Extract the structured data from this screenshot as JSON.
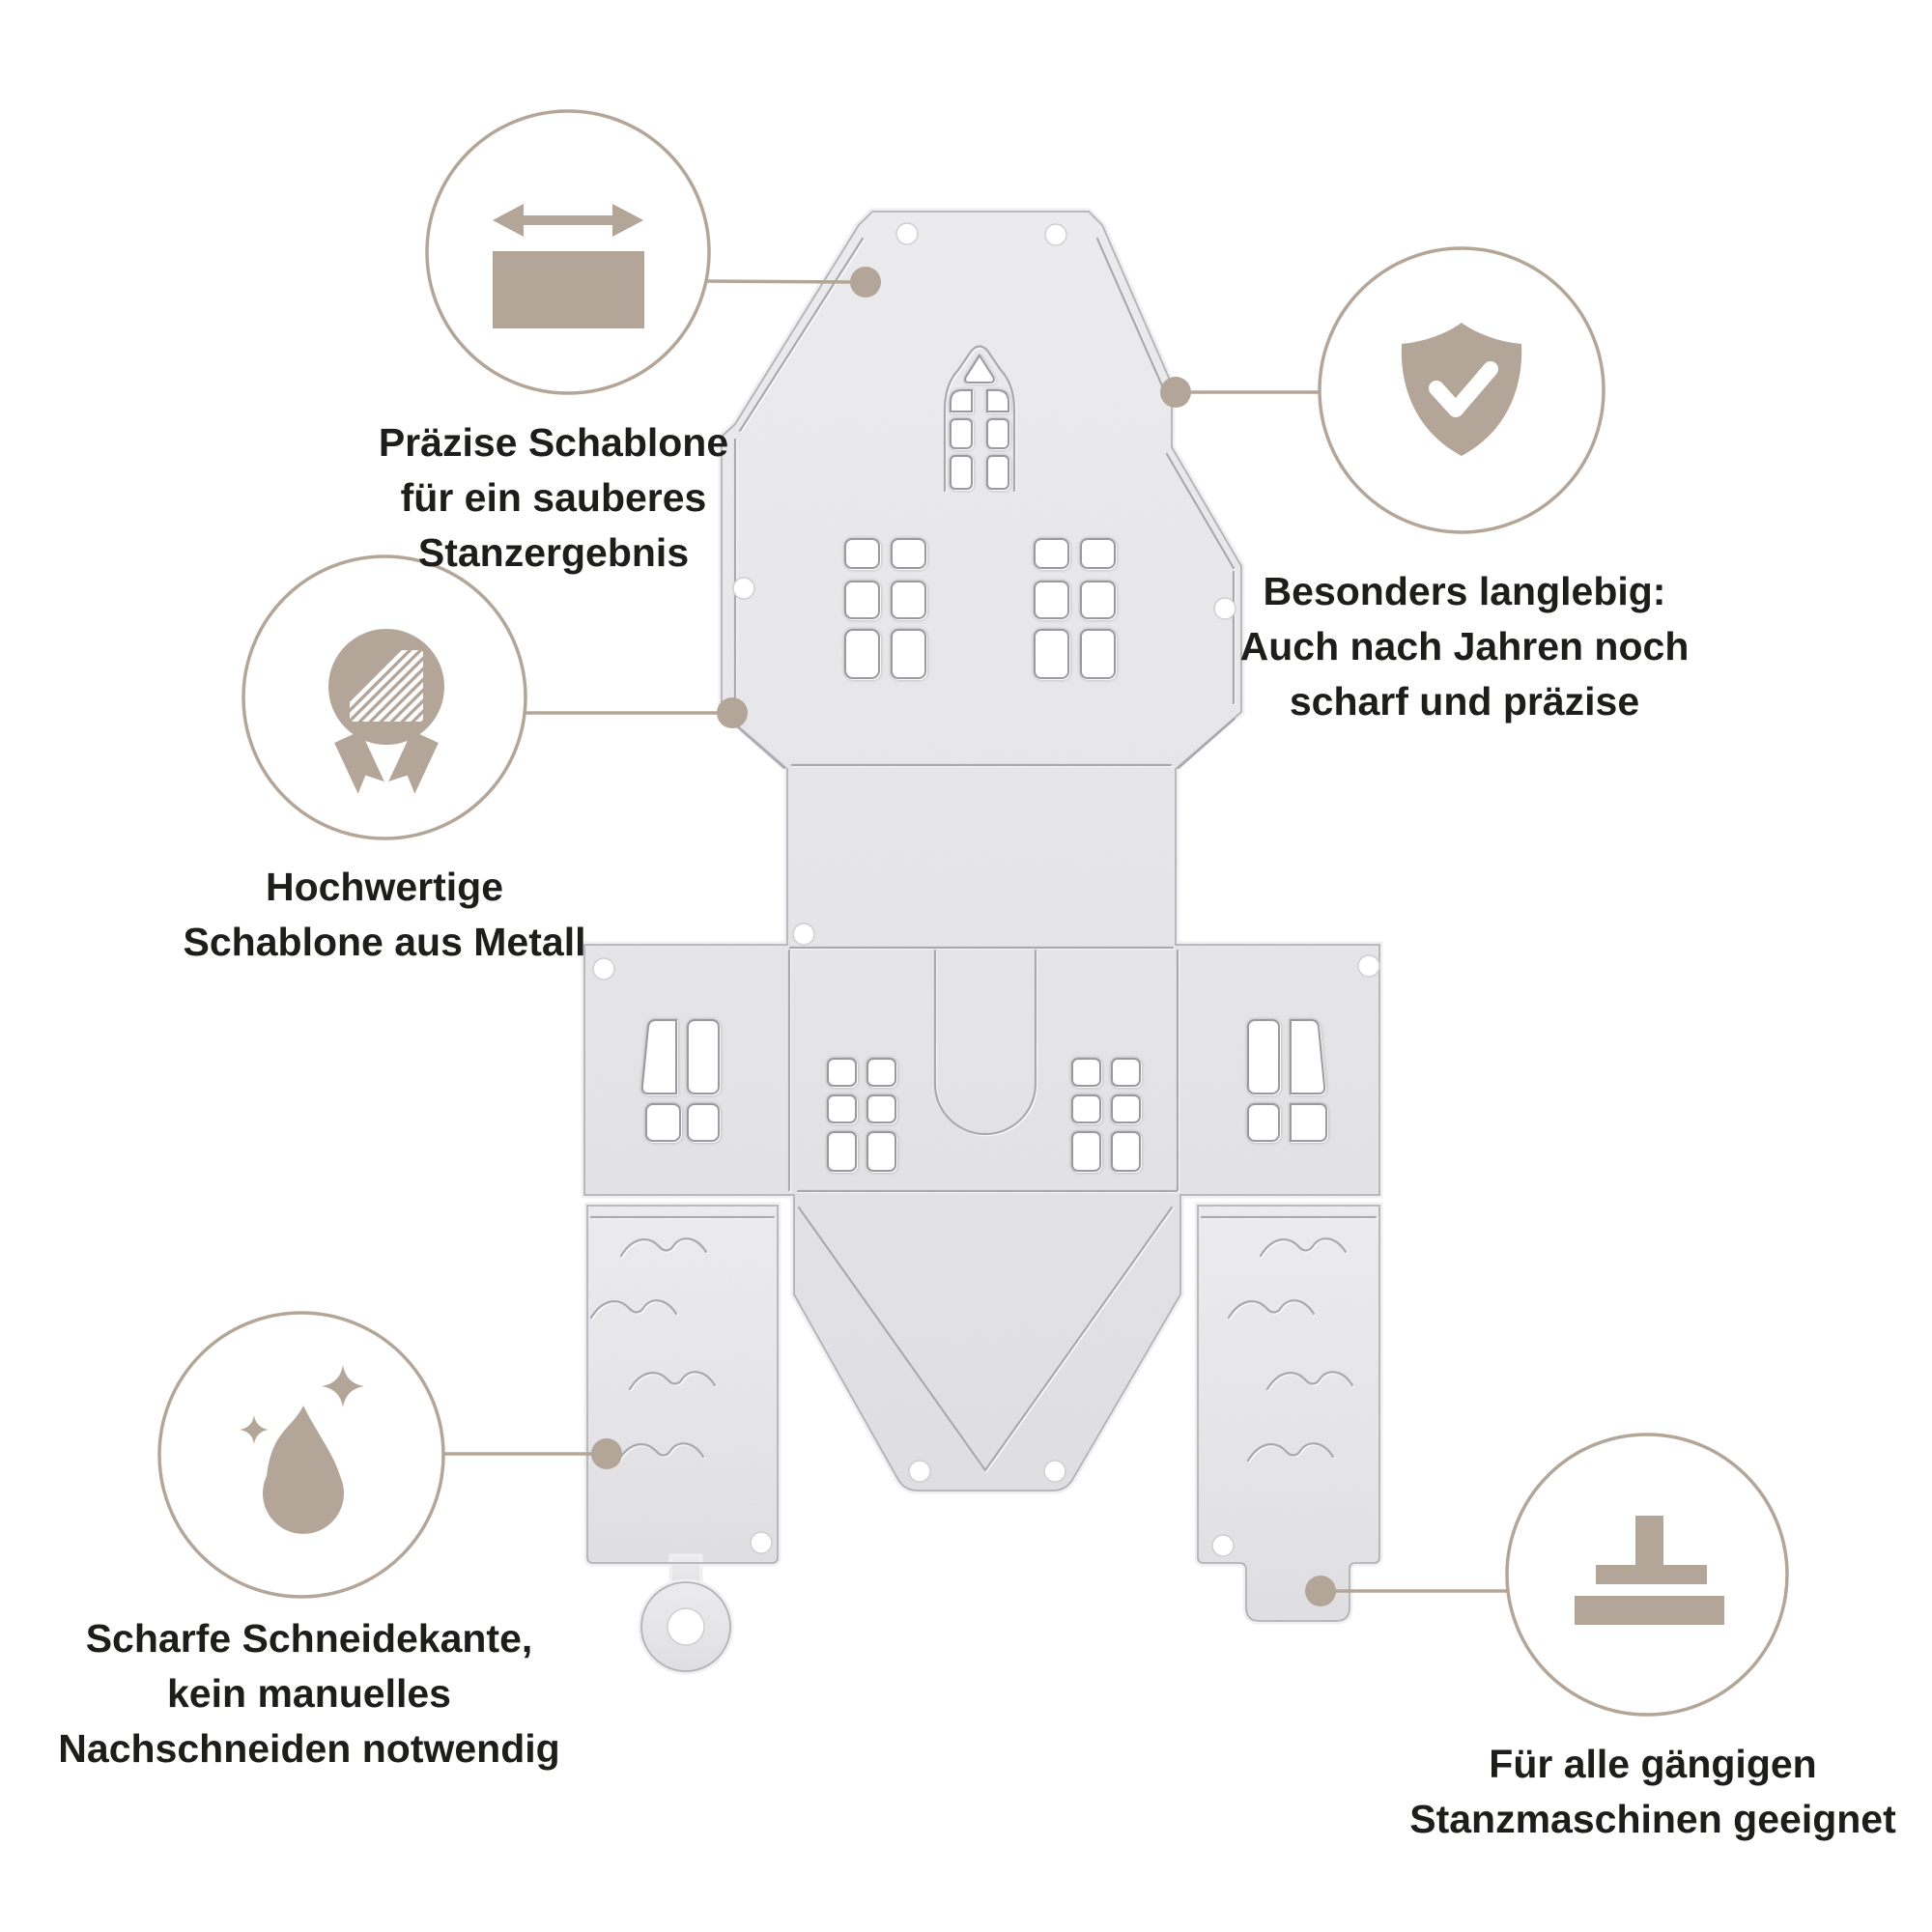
{
  "accent_color": "#b3a698",
  "metal_color": "#e9e9eb",
  "text_color": "#1d1d1b",
  "illustration": {
    "name": "house-die-cut-template",
    "description_visible_elements": "metal die-cut template of a house gift box with windows, door flap, wave embossing, ring tag and machine tab"
  },
  "features": [
    {
      "id": "precision",
      "icon": "width-arrows-icon",
      "lines": [
        "Präzise Schablone",
        "für ein sauberes",
        "Stanzergebnis"
      ]
    },
    {
      "id": "quality",
      "icon": "medal-icon",
      "lines": [
        "Hochwertige",
        "Schablone aus Metall"
      ]
    },
    {
      "id": "durability",
      "icon": "shield-check-icon",
      "lines": [
        "Besonders langlebig:",
        "Auch nach Jahren noch",
        "scharf und präzise"
      ]
    },
    {
      "id": "sharp-edge",
      "icon": "droplet-sparkle-icon",
      "lines": [
        "Scharfe Schneidekante,",
        "kein manuelles",
        "Nachschneiden notwendig"
      ]
    },
    {
      "id": "compatibility",
      "icon": "die-press-icon",
      "lines": [
        "Für alle gängigen",
        "Stanzmaschinen geeignet"
      ]
    }
  ]
}
